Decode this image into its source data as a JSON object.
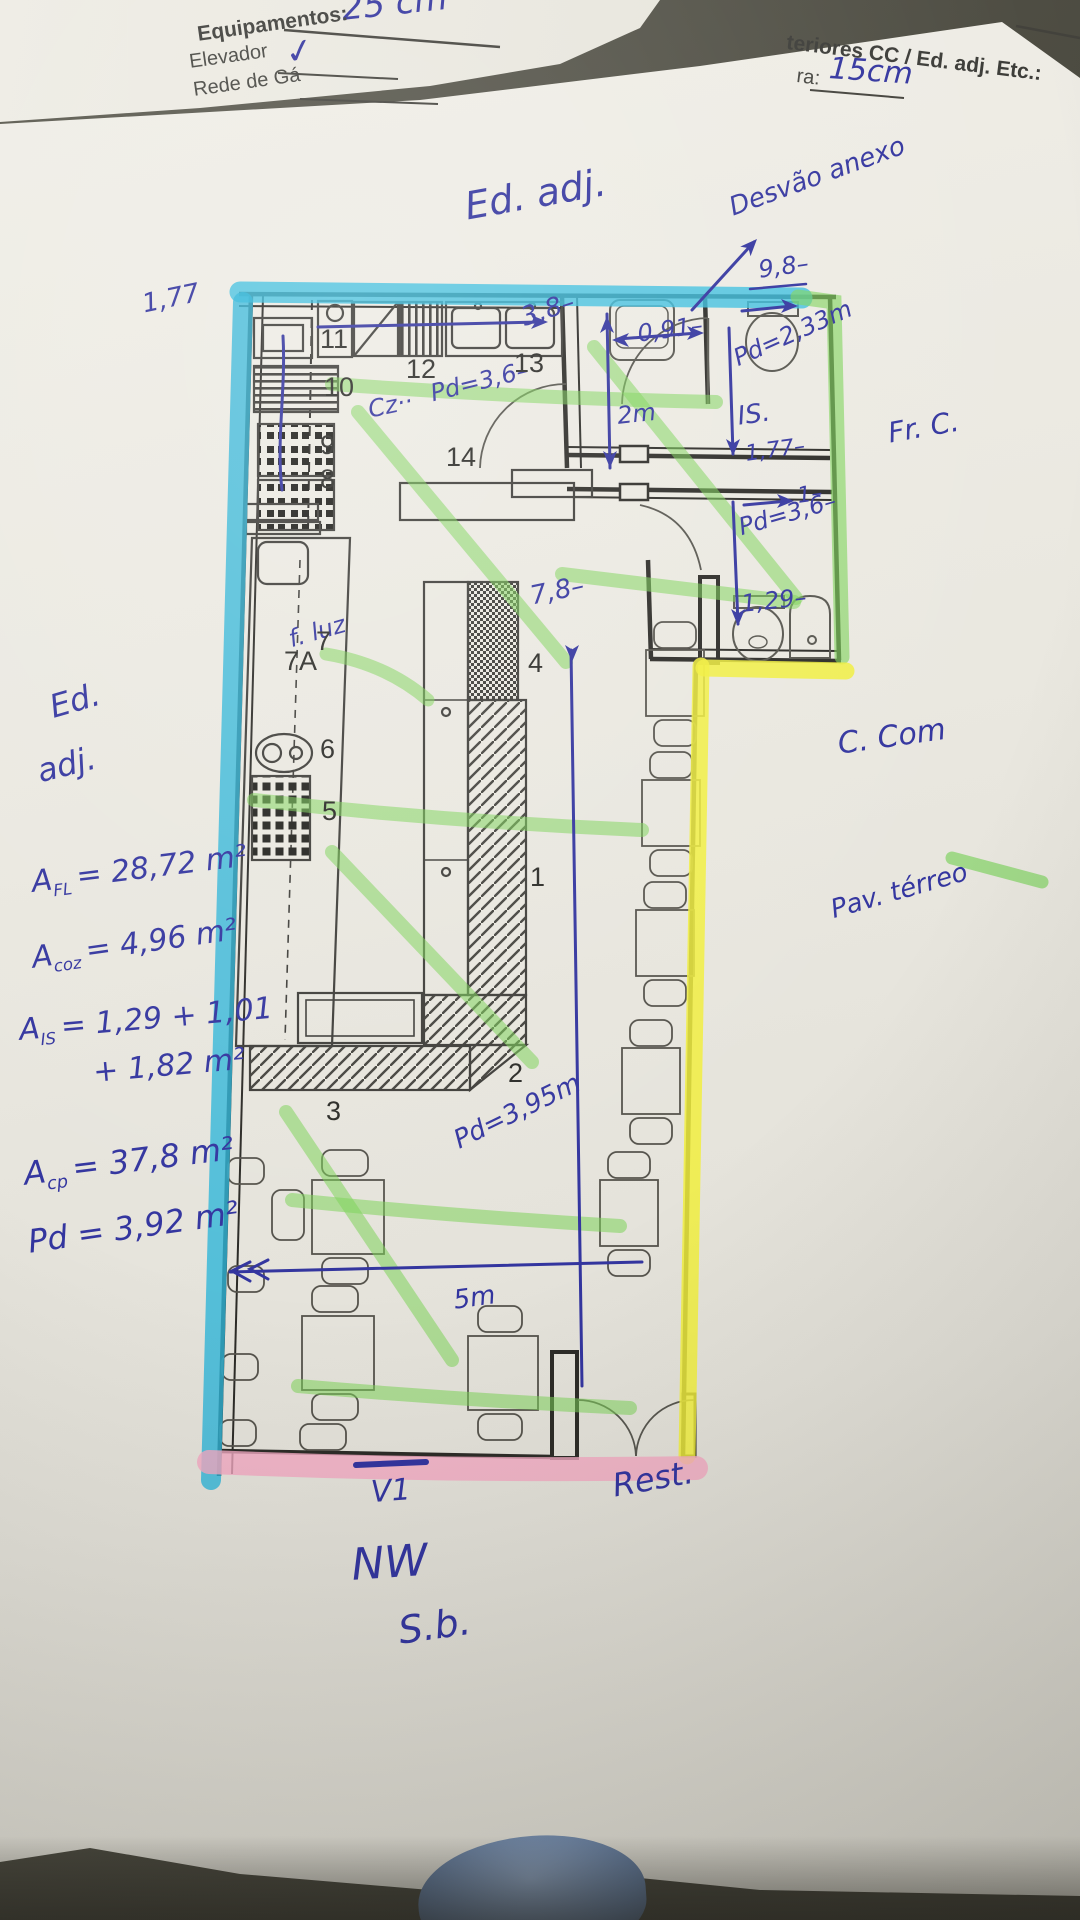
{
  "sheet_left": {
    "handwritten_dim": "25 cm",
    "heading": "Equipamentos:",
    "item1": "Elevador",
    "check_mark": "✓",
    "item2": "Rede de Gá"
  },
  "sheet_right": {
    "printed_header": "teriores CC / Ed. adj. Etc.:",
    "field_label": "ra:",
    "field_value": "15cm"
  },
  "plan_notes": {
    "ed_adj_top": "Ed. adj.",
    "desvao": "Desvão anexo",
    "d98": "9,8–",
    "d091": "0,91–",
    "d38": "3,8–",
    "d2m": "2m",
    "pd233": "Pd=2,33m",
    "is": "IS.",
    "d177_is": "1,77–",
    "one": "1–",
    "pd36_r": "Pd=3,6–",
    "d129": "1,29–",
    "frc": "Fr. C.",
    "d177_l": "1,77",
    "cz": "Cz··",
    "pd36_k": "Pd=3,6–",
    "ed_l1": "Ed.",
    "ed_l2": "adj.",
    "d78": "7,8–",
    "fluz": "f. luz",
    "ccom": "C. Com",
    "pav": "Pav. térreo",
    "pd395": "Pd=3,95m",
    "d5m": "5m",
    "v1": "V1",
    "rest": "Rest.",
    "nw": "NW",
    "sb": "S.b."
  },
  "areas": {
    "fl_sym": "A",
    "fl_sub": "FL",
    "fl_val": "= 28,72 m²",
    "coz_sym": "A",
    "coz_sub": "coz",
    "coz_val": "= 4,96 m²",
    "is_sym": "A",
    "is_sub": "IS",
    "is_val": "= 1,29 + 1,01",
    "is_line2": "+ 1,82 m²",
    "cp_sym": "A",
    "cp_sub": "cp",
    "cp_val": "= 37,8 m²",
    "pd_total": "Pd = 3,92 m²"
  },
  "rooms": {
    "r1": "1",
    "r2": "2",
    "r3": "3",
    "r4": "4",
    "r5": "5",
    "r6": "6",
    "r7": "7",
    "r7a": "7A",
    "r8": "8",
    "r9": "9",
    "r10": "10",
    "r11": "11",
    "r12": "12",
    "r13": "13",
    "r14": "14"
  },
  "colors": {
    "pen_blue": "#33359f",
    "highlight_cyan": "#38bedf",
    "highlight_green": "#7ed459",
    "highlight_yellow": "#f1ee3e",
    "highlight_pink": "#f2a9c2",
    "paper": "#ebe9e1"
  }
}
